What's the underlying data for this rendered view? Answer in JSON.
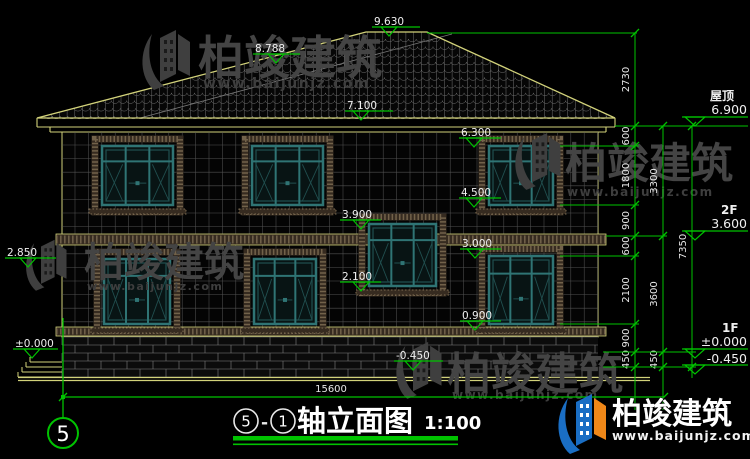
{
  "watermark": {
    "cn": "柏竣建筑",
    "url": "www.baijunjz.com"
  },
  "brand": {
    "cn": "柏竣建筑",
    "url": "www.baijunjz.com"
  },
  "title_block": {
    "axis_left": "5",
    "separator": "-",
    "axis_right": "1",
    "name": "轴立面图",
    "scale": "1:100"
  },
  "axis_bubble": {
    "label": "5"
  },
  "bottom_dim": {
    "value": "15600"
  },
  "right_levels": [
    {
      "label": "屋顶",
      "value": "6.900",
      "label_x": 710,
      "label_y": 100,
      "value_y": 114,
      "line_y": 117,
      "apex_y": 126
    },
    {
      "label": "2F",
      "value": "3.600",
      "label_x": 721,
      "label_y": 214,
      "value_y": 228,
      "line_y": 231,
      "apex_y": 240
    },
    {
      "label": "1F",
      "value": "±0.000",
      "label_x": 722,
      "label_y": 332,
      "value_y": 346,
      "line_y": 349,
      "apex_y": 358
    },
    {
      "label": "",
      "value": "-0.450",
      "label_x": 722,
      "label_y": 0,
      "value_y": 363,
      "line_y": 365,
      "apex_y": 374
    }
  ],
  "elevation_markers": [
    {
      "v": "9.630",
      "tx": 374,
      "ty": 25,
      "lx1": 372,
      "lx2": 420,
      "ly": 27,
      "tcx": 389
    },
    {
      "v": "8.788",
      "tx": 255,
      "ty": 52,
      "lx1": 253,
      "lx2": 300,
      "ly": 54,
      "tcx": 276
    },
    {
      "v": "7.100",
      "tx": 347,
      "ty": 109,
      "lx1": 345,
      "lx2": 393,
      "ly": 111,
      "tcx": 361
    },
    {
      "v": "6.300",
      "tx": 461,
      "ty": 136,
      "lx1": 459,
      "lx2": 501,
      "ly": 138,
      "tcx": 474
    },
    {
      "v": "4.500",
      "tx": 461,
      "ty": 196,
      "lx1": 459,
      "lx2": 501,
      "ly": 198,
      "tcx": 474
    },
    {
      "v": "3.900",
      "tx": 342,
      "ty": 218,
      "lx1": 340,
      "lx2": 381,
      "ly": 220,
      "tcx": 361
    },
    {
      "v": "3.000",
      "tx": 462,
      "ty": 247,
      "lx1": 460,
      "lx2": 501,
      "ly": 249,
      "tcx": 475
    },
    {
      "v": "2.100",
      "tx": 342,
      "ty": 280,
      "lx1": 340,
      "lx2": 381,
      "ly": 282,
      "tcx": 361
    },
    {
      "v": "0.900",
      "tx": 462,
      "ty": 319,
      "lx1": 460,
      "lx2": 501,
      "ly": 321,
      "tcx": 475
    },
    {
      "v": "-0.450",
      "tx": 396,
      "ty": 359,
      "lx1": 394,
      "lx2": 443,
      "ly": 361,
      "tcx": 413
    },
    {
      "v": "2.850",
      "tx": 7,
      "ty": 256,
      "lx1": 5,
      "lx2": 56,
      "ly": 258,
      "tcx": 28
    },
    {
      "v": "±0.000",
      "tx": 15,
      "ty": 347,
      "lx1": 13,
      "lx2": 58,
      "ly": 349,
      "tcx": 32
    }
  ],
  "dim_chains": [
    {
      "x": 635,
      "y_end": 410,
      "ticks": [
        33,
        126,
        146,
        205,
        236,
        256,
        324,
        352,
        367
      ],
      "labels": [
        "2730",
        "600",
        "1800",
        "900",
        "600",
        "2100",
        "900",
        "450"
      ]
    },
    {
      "x": 663,
      "y_end": 410,
      "ticks": [
        126,
        236,
        352,
        367
      ],
      "labels": [
        "3300",
        "3600",
        "450"
      ]
    },
    {
      "x": 692,
      "y_end": 378,
      "ticks": [
        126,
        367
      ],
      "labels": [
        "7350"
      ]
    }
  ],
  "drawing": {
    "windows": [
      {
        "x": 102,
        "y": 146,
        "w": 71,
        "h": 59
      },
      {
        "x": 252,
        "y": 146,
        "w": 71,
        "h": 59
      },
      {
        "x": 489,
        "y": 146,
        "w": 64,
        "h": 59
      },
      {
        "x": 369,
        "y": 224,
        "w": 67,
        "h": 62
      },
      {
        "x": 104,
        "y": 259,
        "w": 66,
        "h": 65
      },
      {
        "x": 254,
        "y": 259,
        "w": 62,
        "h": 65
      },
      {
        "x": 489,
        "y": 256,
        "w": 64,
        "h": 68
      }
    ],
    "ext_lines": [
      [
        427,
        33,
        637,
        33
      ],
      [
        615,
        126,
        748,
        126
      ],
      [
        560,
        146,
        639,
        146
      ],
      [
        560,
        205,
        639,
        205
      ],
      [
        606,
        236,
        667,
        236
      ],
      [
        560,
        256,
        639,
        256
      ],
      [
        560,
        324,
        639,
        324
      ],
      [
        603,
        352,
        696,
        352
      ],
      [
        603,
        367,
        696,
        367
      ]
    ],
    "watermark_spots": [
      {
        "mx": 140,
        "my": 28,
        "ms": 1.0,
        "cnx": 198,
        "cny": 74,
        "cf": 46,
        "ux": 203,
        "uy": 88,
        "uf": 14
      },
      {
        "mx": 513,
        "my": 131,
        "ms": 0.95,
        "cnx": 565,
        "cny": 178,
        "cf": 42,
        "ux": 567,
        "uy": 196,
        "uf": 12
      },
      {
        "mx": 24,
        "my": 238,
        "ms": 0.85,
        "cnx": 84,
        "cny": 276,
        "cf": 40,
        "ux": 87,
        "uy": 290,
        "uf": 11
      },
      {
        "mx": 394,
        "my": 340,
        "ms": 0.95,
        "cnx": 447,
        "cny": 389,
        "cf": 44,
        "ux": 452,
        "uy": 399,
        "uf": 12
      }
    ]
  },
  "colors": {
    "green": "#00c300",
    "yellow": "#d2d27a",
    "teal": "#2f7474",
    "teal_dark": "#214f4f",
    "glass": "#081414",
    "decor_dark": "#362b20",
    "decor_light": "#7d6c52",
    "grid": "#5f5f5f",
    "rooftile": "#8e8e8e",
    "white": "#e8e8e8",
    "brand_blue": "#1a6ec4",
    "brand_orange": "#ef8718"
  }
}
